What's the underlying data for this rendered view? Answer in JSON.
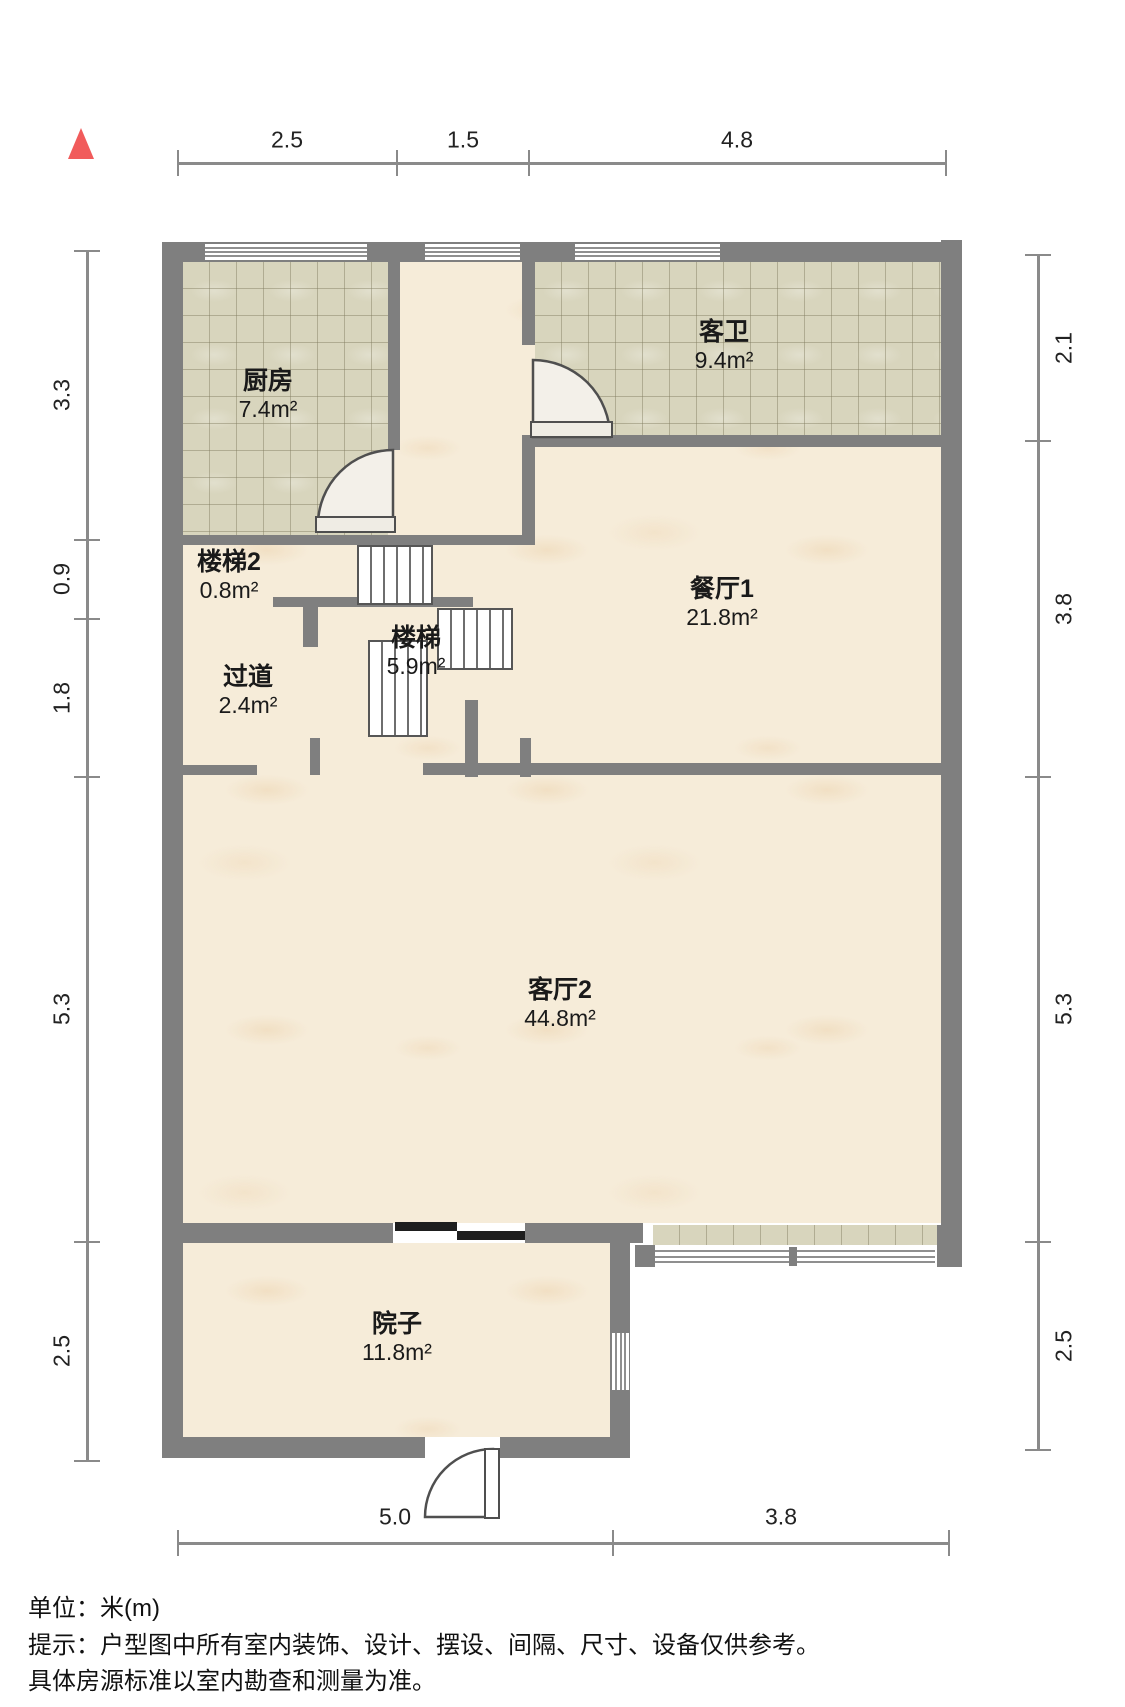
{
  "rooms": [
    {
      "id": "kitchen",
      "name": "厨房",
      "area": "7.4m²"
    },
    {
      "id": "guest-bath",
      "name": "客卫",
      "area": "9.4m²"
    },
    {
      "id": "stair-2",
      "name": "楼梯2",
      "area": "0.8m²"
    },
    {
      "id": "dining-1",
      "name": "餐厅1",
      "area": "21.8m²"
    },
    {
      "id": "stair",
      "name": "楼梯",
      "area": "5.9m²"
    },
    {
      "id": "hallway",
      "name": "过道",
      "area": "2.4m²"
    },
    {
      "id": "living-2",
      "name": "客厅2",
      "area": "44.8m²"
    },
    {
      "id": "yard",
      "name": "院子",
      "area": "11.8m²"
    }
  ],
  "dimensions": {
    "top": [
      "2.5",
      "1.5",
      "4.8"
    ],
    "left": [
      "3.3",
      "0.9",
      "1.8",
      "5.3",
      "2.5"
    ],
    "right": [
      "2.1",
      "3.8",
      "5.3",
      "2.5"
    ],
    "bottom": [
      "5.0",
      "3.8"
    ]
  },
  "footer": {
    "line1": "单位：米(m)",
    "line2": "提示：户型图中所有室内装饰、设计、摆设、间隔、尺寸、设备仅供参考。",
    "line3": "具体房源标准以室内勘查和测量为准。"
  },
  "icons": {
    "compass": "north-indicator-triangle"
  },
  "colors": {
    "wall": "#7f7f7f",
    "marble_floor": "#f6ecd9",
    "tile_floor": "#d8d5bd",
    "compass_red": "#f15b5b",
    "sliding_door": "#1e1e1e"
  }
}
